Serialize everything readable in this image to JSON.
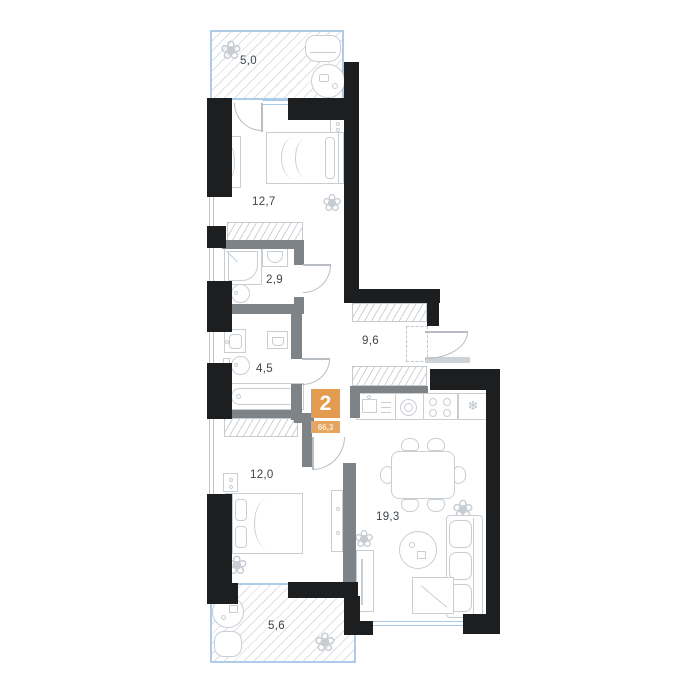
{
  "floor_plan": {
    "badge": {
      "rooms_count": "2",
      "total_area": "66,3"
    },
    "rooms": [
      {
        "name": "balcony-top",
        "area": "5,0"
      },
      {
        "name": "bedroom-top",
        "area": "12,7"
      },
      {
        "name": "shower-room",
        "area": "2,9"
      },
      {
        "name": "hallway",
        "area": "9,6"
      },
      {
        "name": "bathroom",
        "area": "4,5"
      },
      {
        "name": "bedroom-bottom",
        "area": "12,0"
      },
      {
        "name": "kitchen-living-room",
        "area": "19,3"
      },
      {
        "name": "balcony-bottom",
        "area": "5,6"
      }
    ],
    "icons": {
      "plant": "❀",
      "fridge": "❄"
    },
    "colors": {
      "wall": "#1d1e1f",
      "partition": "#7e8388",
      "window": "#a9c9e6",
      "furniture_line": "#c9ced3",
      "badge_orange": "#e29b4f",
      "label_text": "#3f4449"
    }
  }
}
